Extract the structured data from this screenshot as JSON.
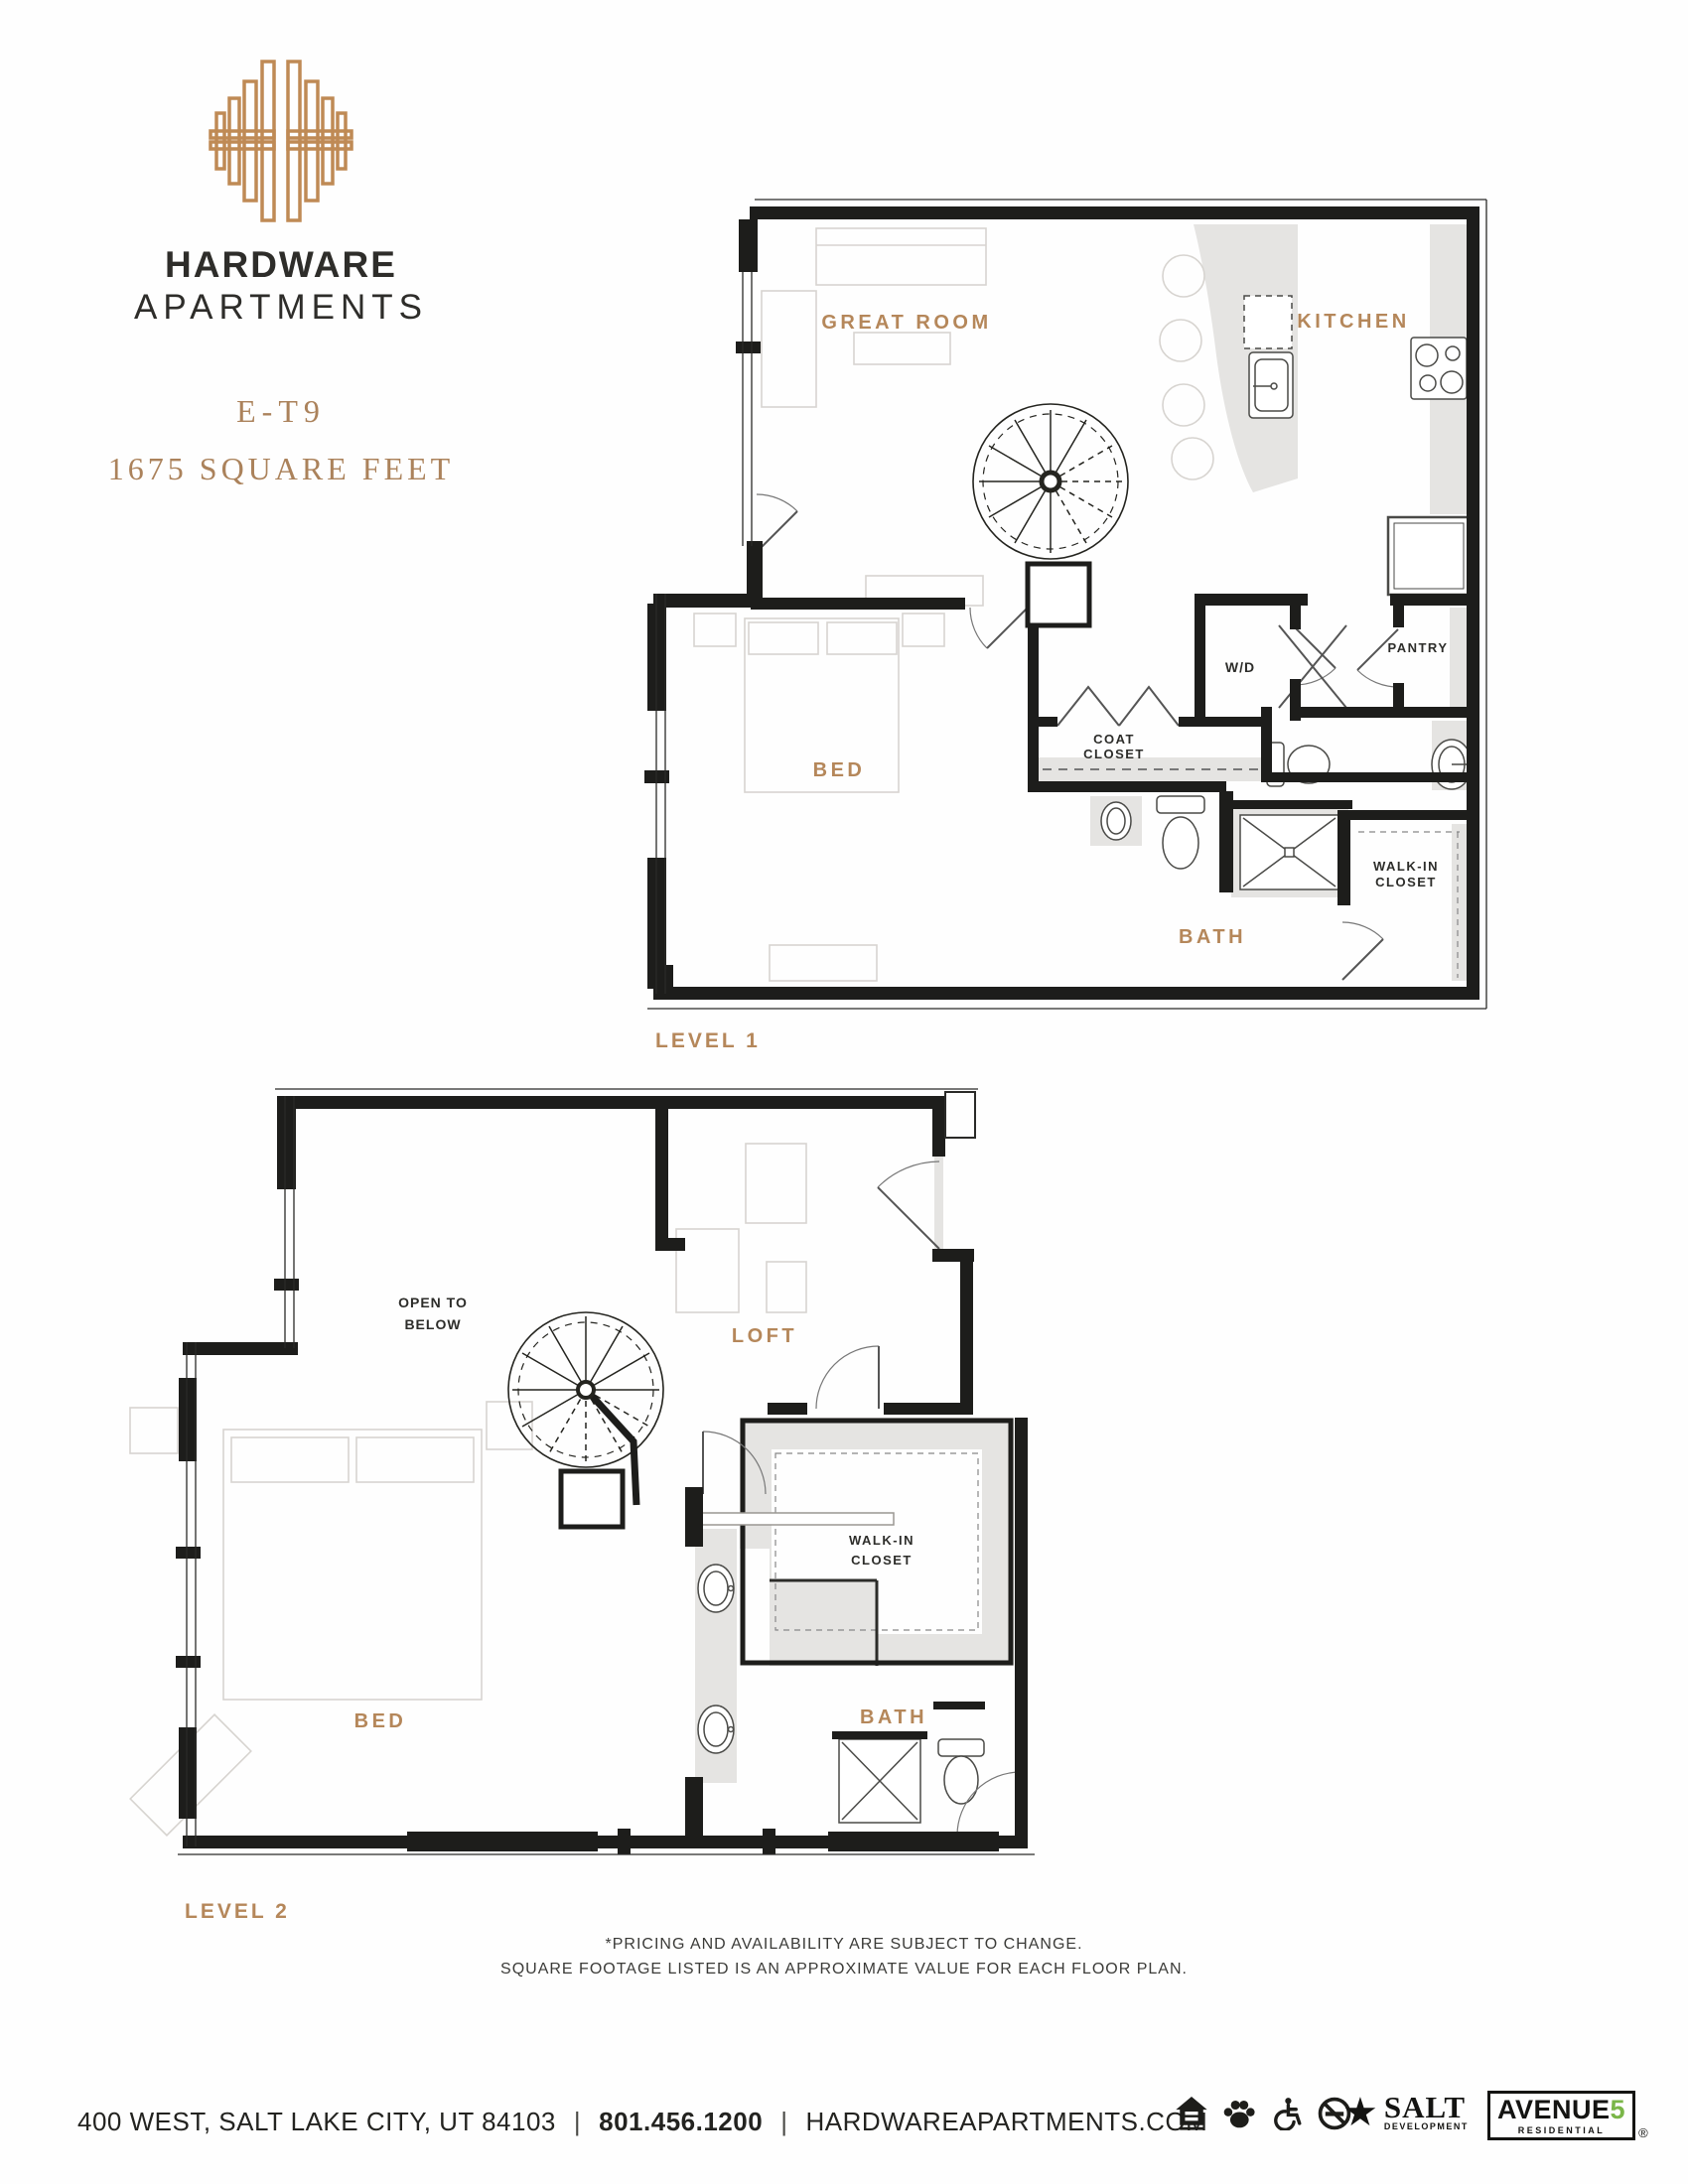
{
  "brand": {
    "line1": "HARDWARE",
    "line2": "APARTMENTS",
    "logo": "hardware-h-logomark"
  },
  "unit": {
    "code": "E-T9",
    "size": "1675 SQUARE FEET"
  },
  "plans": {
    "level1": {
      "caption": "LEVEL 1",
      "labels": {
        "great_room": "GREAT ROOM",
        "kitchen": "KITCHEN",
        "bed": "BED",
        "bath": "BATH",
        "wd": "W/D",
        "pantry": "PANTRY",
        "coat1": "COAT",
        "coat2": "CLOSET",
        "walkin1": "WALK-IN",
        "walkin2": "CLOSET"
      }
    },
    "level2": {
      "caption": "LEVEL 2",
      "labels": {
        "open1": "OPEN TO",
        "open2": "BELOW",
        "loft": "LOFT",
        "walkin1": "WALK-IN",
        "walkin2": "CLOSET",
        "bed": "BED",
        "bath": "BATH"
      }
    }
  },
  "disclaimer": {
    "line1": "*PRICING AND AVAILABILITY ARE SUBJECT TO CHANGE.",
    "line2": "SQUARE FOOTAGE LISTED IS AN APPROXIMATE VALUE FOR EACH FLOOR PLAN."
  },
  "footer": {
    "address": "400 WEST, SALT LAKE CITY, UT 84103",
    "phone": "801.456.1200",
    "website": "HARDWAREAPARTMENTS.COM",
    "separator": "|",
    "icons": [
      "equal-housing-icon",
      "pet-friendly-icon",
      "accessible-icon",
      "no-smoking-icon"
    ],
    "salt": {
      "star": "★",
      "line1": "SALT",
      "line2": "DEVELOPMENT"
    },
    "avenue5": {
      "line1": "AVENUE",
      "five": "5",
      "line2": "RESIDENTIAL",
      "reg": "®"
    }
  },
  "colors": {
    "copper": "#b5875a",
    "logo_copper": "#bf8a55",
    "ink": "#2d2d2a",
    "wall": "#1d1d1b",
    "shade_gray": "#e5e4e2",
    "avenue5_green": "#7ab648"
  }
}
